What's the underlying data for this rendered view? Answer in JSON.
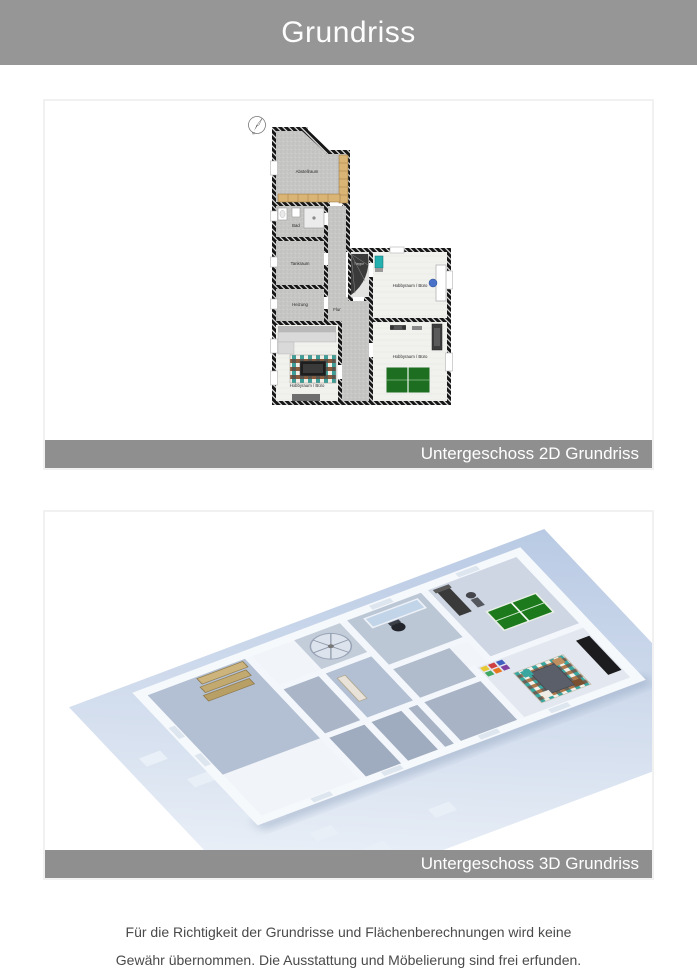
{
  "header": {
    "title": "Grundriss"
  },
  "panels": {
    "plan2d": {
      "caption": "Untergeschoss 2D Grundriss"
    },
    "plan3d": {
      "caption": "Untergeschoss 3D Grundriss"
    }
  },
  "plan2d": {
    "compass_label": "N",
    "rooms": {
      "abstellraum": "Abstellraum",
      "bad": "Bad",
      "tankraum": "Tankraum",
      "heizung": "Heizung",
      "flur": "Flur",
      "treppe": "Treppe",
      "hobbyraum_top": "Hobbyraum / Büro",
      "hobbyraum_right": "Hobbyraum / Büro",
      "hobbyraum_left": "Hobbyraum / Büro"
    }
  },
  "footer": {
    "line1": "Für die Richtigkeit der Grundrisse und Flächenberechnungen wird keine",
    "line2": "Gewähr übernommen. Die Ausstattung und Möbelierung sind frei erfunden."
  },
  "colors": {
    "header_bg": "#969696",
    "caption_bg": "#8f8f8f",
    "panel_border": "#f1f1f1",
    "footer_text": "#4a4a4a",
    "wall_hatch": "#161616",
    "concrete_floor": "#c7c7c5",
    "light_floor": "#f1f1ee",
    "shelf_tan": "#d9b475",
    "table_tennis_green": "#1d6e20",
    "slab_blue": "#b9cae4",
    "wall_3d": "#f3f7fc"
  }
}
